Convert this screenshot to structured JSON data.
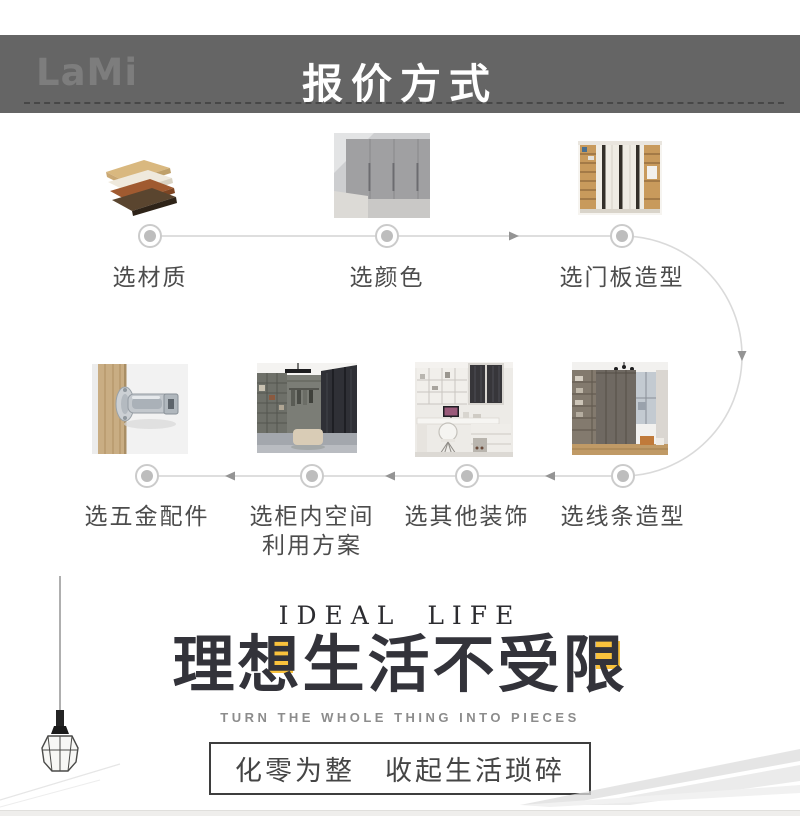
{
  "header": {
    "logo": "LaMi",
    "title": "报价方式"
  },
  "flow": {
    "top": [
      {
        "label": "选材质",
        "photo": "material-samples-photo"
      },
      {
        "label": "选颜色",
        "photo": "wardrobe-color-photo"
      },
      {
        "label": "选门板造型",
        "photo": "door-panel-style-photo"
      }
    ],
    "bottom": [
      {
        "label": "选五金配件",
        "photo": "hinge-hardware-photo"
      },
      {
        "label_line1": "选柜内空间",
        "label_line2": "利用方案",
        "photo": "closet-interior-photo"
      },
      {
        "label": "选其他装饰",
        "photo": "other-decor-photo"
      },
      {
        "label": "选线条造型",
        "photo": "moulding-style-photo"
      }
    ]
  },
  "hero": {
    "eyebrow": "IDEAL LIFE",
    "title": "理想生活不受限",
    "title_chars": [
      "理",
      "想",
      "生",
      "活",
      "不",
      "受",
      "限"
    ],
    "highlight_char_indices": [
      1,
      6
    ],
    "subtitle": "TURN THE WHOLE THING INTO PIECES",
    "tagline": "化零为整　收起生活琐碎"
  },
  "colors": {
    "header_bar": "#656565",
    "header_text": "#ffffff",
    "highlight_yellow": "#f9c23c",
    "timeline_line": "#d4d4d4",
    "timeline_node": "#bdbdbd",
    "label_text": "#4c4c4c",
    "title_text": "#33333a"
  }
}
